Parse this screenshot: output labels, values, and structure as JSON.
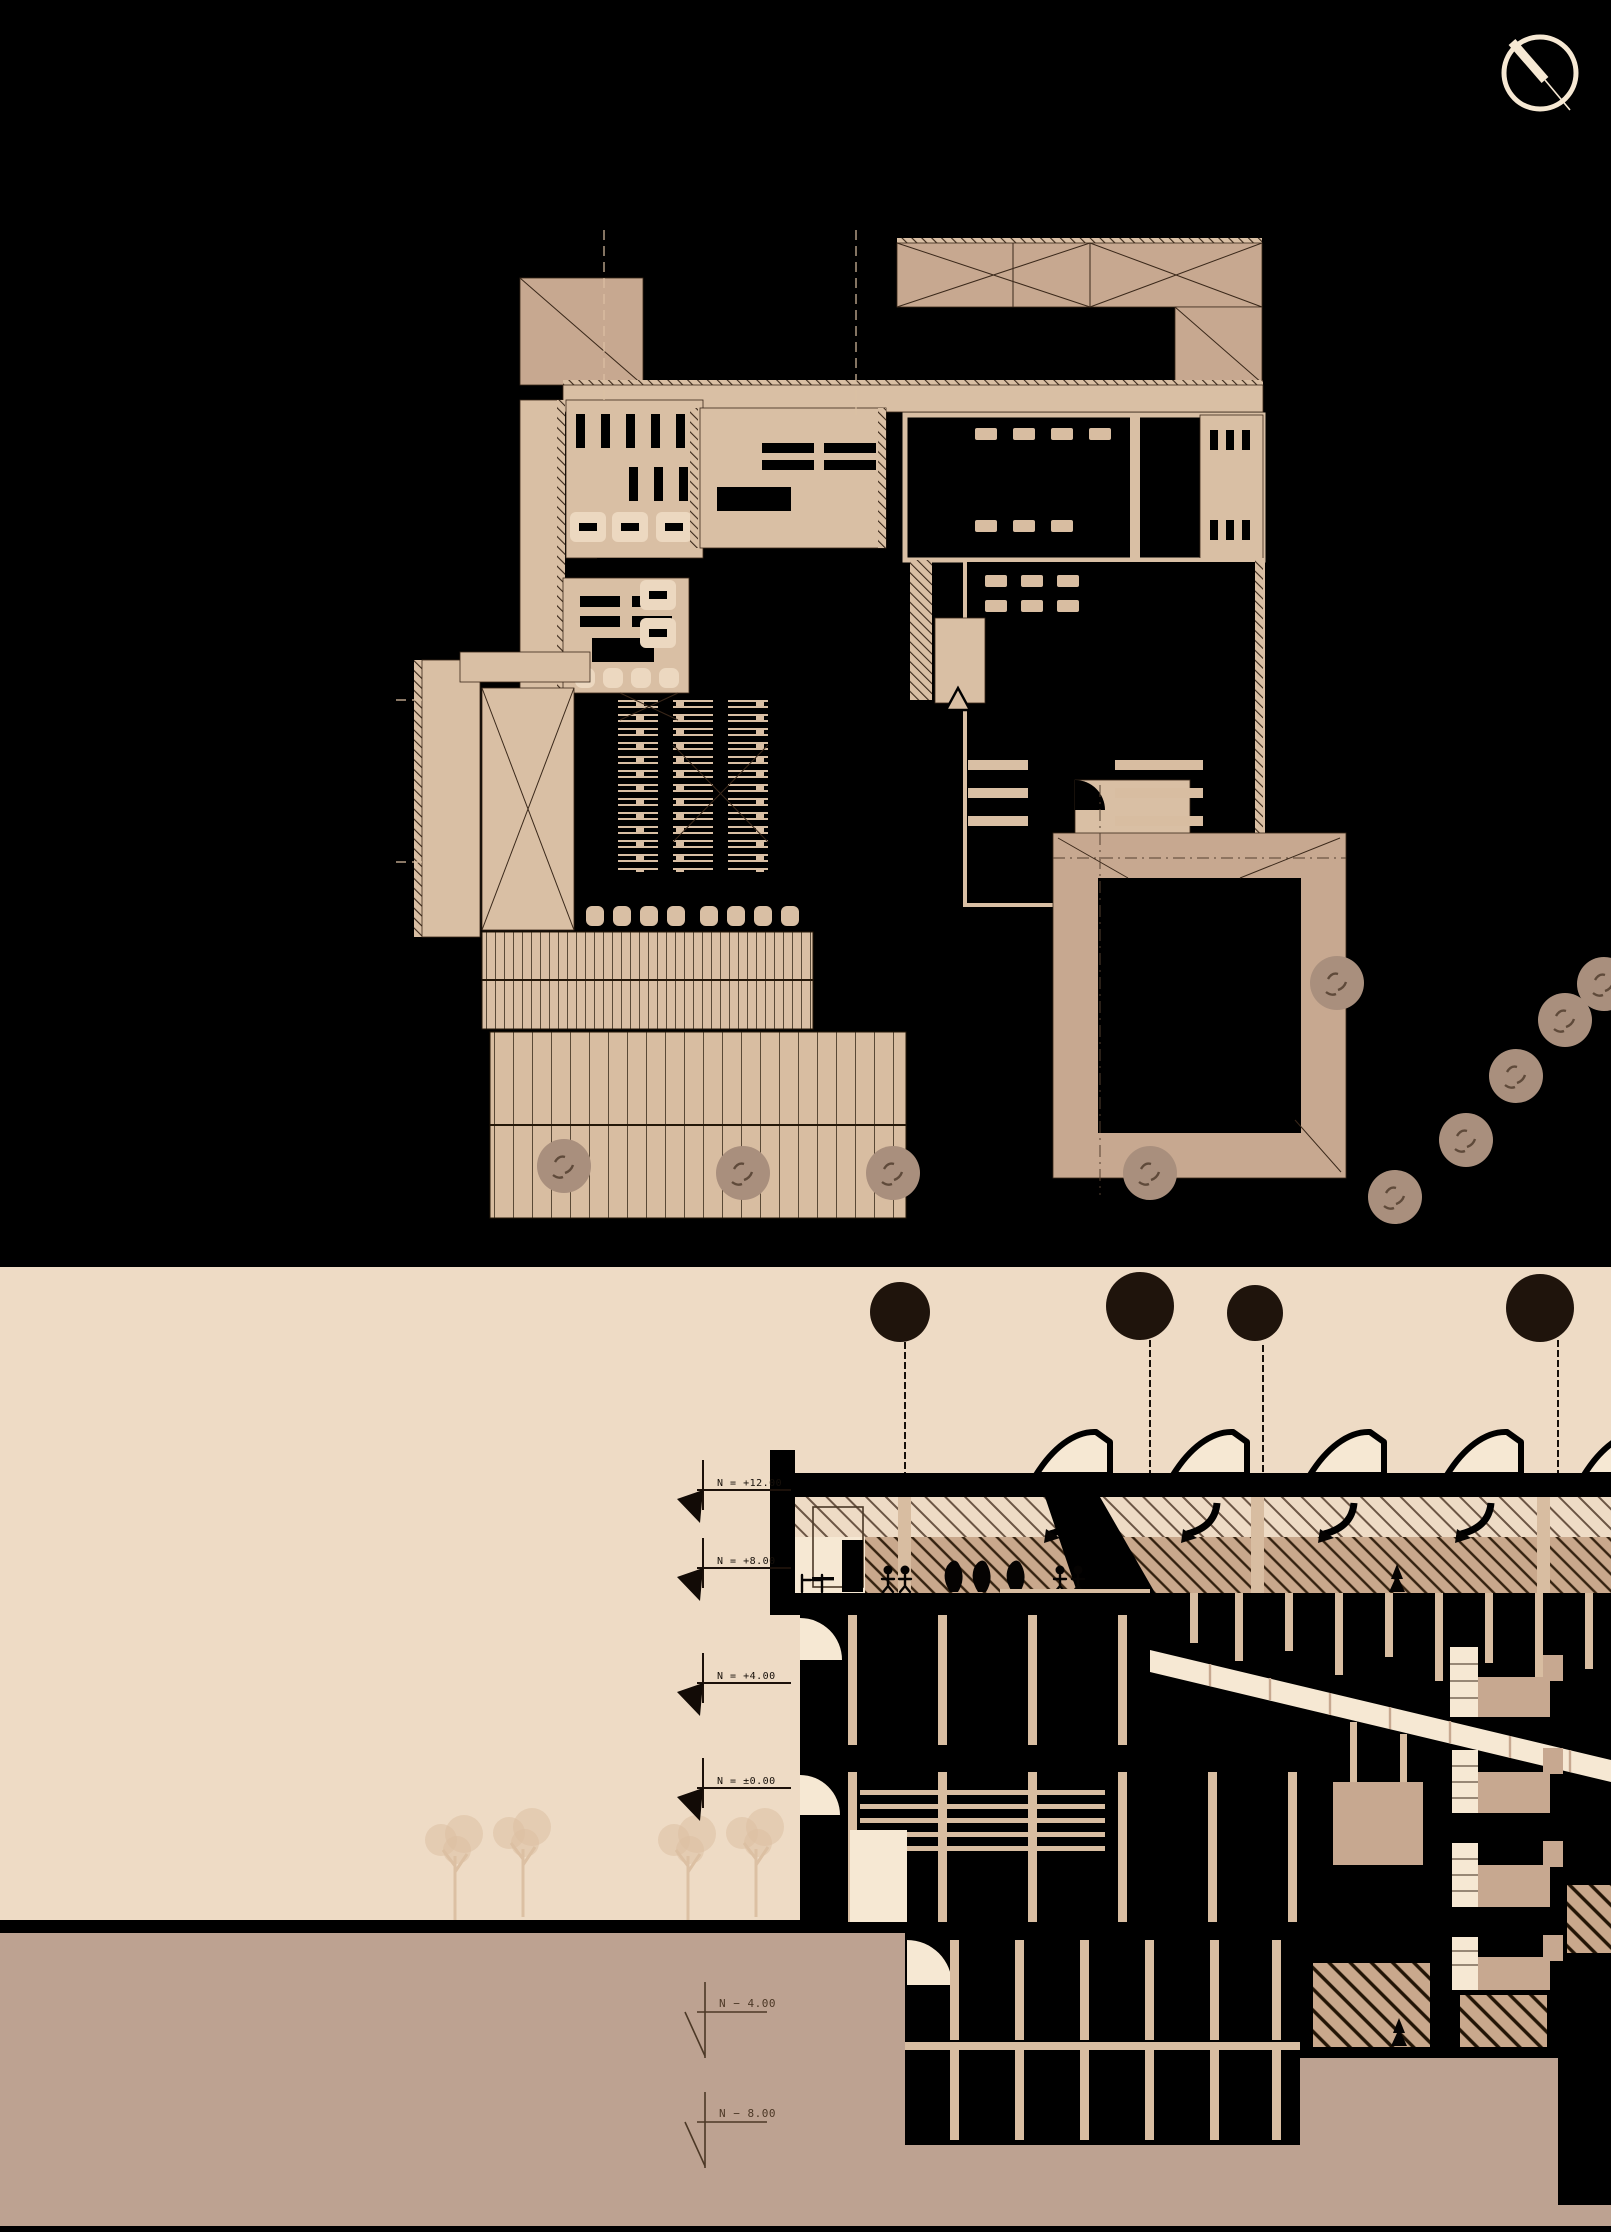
{
  "title": "architectural drawing — floor plan and building section",
  "palette": {
    "c-black": "#000000",
    "c-plan": "#d9bfa4",
    "c-room": "#ecd8c0",
    "c-roof": "#c7a890",
    "c-col": "#d8bda1",
    "c-sky": "#eedbc5",
    "c-cream": "#f6e8d3",
    "c-ground": "#bda291",
    "c-treeplan": "#a98f7d",
    "c-treedark": "#1f140c",
    "c-ghost": "#dcc0a3",
    "c-line": "#3a281a",
    "c-hatchtan": "#c9a88c"
  },
  "north_arrow": {
    "icon": "north-arrow-icon"
  },
  "section": {
    "sky_markers": [
      {
        "label": "N = +12.00"
      },
      {
        "label": "N = +8.00"
      },
      {
        "label": "N = +4.00"
      },
      {
        "label": "N = ±0.00"
      }
    ],
    "ground_markers": [
      {
        "label": "N − 4.00"
      },
      {
        "label": "N − 8.00"
      }
    ]
  }
}
